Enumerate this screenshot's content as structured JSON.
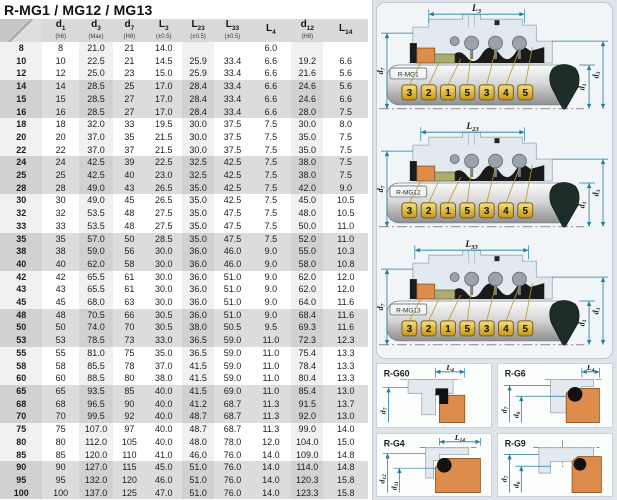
{
  "title": "R-MG1 / MG12 / MG13",
  "colors": {
    "dimension": "#1d7da3",
    "tag_fill": "#e9c654",
    "tag_border": "#7c5e12",
    "orange": "#dd8c4c",
    "olive": "#abac6e",
    "black_part": "#1a1a1a",
    "gland": "#e3eaef",
    "gland_stroke": "#98a6b0",
    "row_band": "#dcdcdc",
    "header_bg": "#d9d9d9"
  },
  "table": {
    "headers": [
      {
        "main": "d",
        "sub": "1",
        "note": "(h6)"
      },
      {
        "main": "d",
        "sub": "3",
        "note": "(Max)"
      },
      {
        "main": "d",
        "sub": "7",
        "note": "(H8)"
      },
      {
        "main": "L",
        "sub": "3",
        "note": "(±0.5)"
      },
      {
        "main": "L",
        "sub": "23",
        "note": "(±0.5)"
      },
      {
        "main": "L",
        "sub": "33",
        "note": "(±0.5)"
      },
      {
        "main": "L",
        "sub": "4",
        "note": ""
      },
      {
        "main": "d",
        "sub": "12",
        "note": "(H8)"
      },
      {
        "main": "L",
        "sub": "14",
        "note": ""
      }
    ],
    "rows": [
      [
        "8",
        "8",
        "21.0",
        "21",
        "14.0",
        "",
        "",
        "6.0",
        "",
        ""
      ],
      [
        "10",
        "10",
        "22.5",
        "21",
        "14.5",
        "25.9",
        "33.4",
        "6.6",
        "19.2",
        "6.6"
      ],
      [
        "12",
        "12",
        "25.0",
        "23",
        "15.0",
        "25.9",
        "33.4",
        "6.6",
        "21.6",
        "5.6"
      ],
      [
        "14",
        "14",
        "28.5",
        "25",
        "17.0",
        "28.4",
        "33.4",
        "6.6",
        "24.6",
        "5.6"
      ],
      [
        "15",
        "15",
        "28.5",
        "27",
        "17.0",
        "28.4",
        "33.4",
        "6.6",
        "24.6",
        "6.6"
      ],
      [
        "16",
        "16",
        "28.5",
        "27",
        "17.0",
        "28.4",
        "33.4",
        "6.6",
        "28.0",
        "7.5"
      ],
      [
        "18",
        "18",
        "32.0",
        "33",
        "19.5",
        "30.0",
        "37.5",
        "7.5",
        "30.0",
        "8.0"
      ],
      [
        "20",
        "20",
        "37.0",
        "35",
        "21.5",
        "30.0",
        "37.5",
        "7.5",
        "35.0",
        "7.5"
      ],
      [
        "22",
        "22",
        "37.0",
        "37",
        "21.5",
        "30.0",
        "37.5",
        "7.5",
        "35.0",
        "7.5"
      ],
      [
        "24",
        "24",
        "42.5",
        "39",
        "22.5",
        "32.5",
        "42.5",
        "7.5",
        "38.0",
        "7.5"
      ],
      [
        "25",
        "25",
        "42.5",
        "40",
        "23.0",
        "32.5",
        "42.5",
        "7.5",
        "38.0",
        "7.5"
      ],
      [
        "28",
        "28",
        "49.0",
        "43",
        "26.5",
        "35.0",
        "42.5",
        "7.5",
        "42.0",
        "9.0"
      ],
      [
        "30",
        "30",
        "49.0",
        "45",
        "26.5",
        "35.0",
        "42.5",
        "7.5",
        "45.0",
        "10.5"
      ],
      [
        "32",
        "32",
        "53.5",
        "48",
        "27.5",
        "35.0",
        "47.5",
        "7.5",
        "48.0",
        "10.5"
      ],
      [
        "33",
        "33",
        "53.5",
        "48",
        "27.5",
        "35.0",
        "47.5",
        "7.5",
        "50.0",
        "11.0"
      ],
      [
        "35",
        "35",
        "57.0",
        "50",
        "28.5",
        "35.0",
        "47.5",
        "7.5",
        "52.0",
        "11.0"
      ],
      [
        "38",
        "38",
        "59.0",
        "56",
        "30.0",
        "36.0",
        "46.0",
        "9.0",
        "55.0",
        "10.3"
      ],
      [
        "40",
        "40",
        "62.0",
        "58",
        "30.0",
        "36.0",
        "46.0",
        "9.0",
        "58.0",
        "10.8"
      ],
      [
        "42",
        "42",
        "65.5",
        "61",
        "30.0",
        "36.0",
        "51.0",
        "9.0",
        "62.0",
        "12.0"
      ],
      [
        "43",
        "43",
        "65.5",
        "61",
        "30.0",
        "36.0",
        "51.0",
        "9.0",
        "62.0",
        "12.0"
      ],
      [
        "45",
        "45",
        "68.0",
        "63",
        "30.0",
        "36.0",
        "51.0",
        "9.0",
        "64.0",
        "11.6"
      ],
      [
        "48",
        "48",
        "70.5",
        "66",
        "30.5",
        "36.0",
        "51.0",
        "9.0",
        "68.4",
        "11.6"
      ],
      [
        "50",
        "50",
        "74.0",
        "70",
        "30.5",
        "38.0",
        "50.5",
        "9.5",
        "69.3",
        "11.6"
      ],
      [
        "53",
        "53",
        "78.5",
        "73",
        "33.0",
        "36.5",
        "59.0",
        "11.0",
        "72.3",
        "12.3"
      ],
      [
        "55",
        "55",
        "81.0",
        "75",
        "35.0",
        "36.5",
        "59.0",
        "11.0",
        "75.4",
        "13.3"
      ],
      [
        "58",
        "58",
        "85.5",
        "78",
        "37.0",
        "41.5",
        "59.0",
        "11.0",
        "78.4",
        "13.3"
      ],
      [
        "60",
        "60",
        "88.5",
        "80",
        "38.0",
        "41.5",
        "59.0",
        "11.0",
        "80.4",
        "13.3"
      ],
      [
        "65",
        "65",
        "93.5",
        "85",
        "40.0",
        "41.5",
        "69.0",
        "11.0",
        "85.4",
        "13.0"
      ],
      [
        "68",
        "68",
        "96.5",
        "90",
        "40.0",
        "41.2",
        "68.7",
        "11.3",
        "91.5",
        "13.7"
      ],
      [
        "70",
        "70",
        "99.5",
        "92",
        "40.0",
        "48.7",
        "68.7",
        "11.3",
        "92.0",
        "13.0"
      ],
      [
        "75",
        "75",
        "107.0",
        "97",
        "40.0",
        "48.7",
        "68.7",
        "11.3",
        "99.0",
        "14.0"
      ],
      [
        "80",
        "80",
        "112.0",
        "105",
        "40.0",
        "48.0",
        "78.0",
        "12.0",
        "104.0",
        "15.0"
      ],
      [
        "85",
        "85",
        "120.0",
        "110",
        "41.0",
        "46.0",
        "76.0",
        "14.0",
        "109.0",
        "14.8"
      ],
      [
        "90",
        "90",
        "127.0",
        "115",
        "45.0",
        "51.0",
        "76.0",
        "14.0",
        "114.0",
        "14.8"
      ],
      [
        "95",
        "95",
        "132.0",
        "120",
        "46.0",
        "51.0",
        "76.0",
        "14.0",
        "120.3",
        "15.8"
      ],
      [
        "100",
        "100",
        "137.0",
        "125",
        "47.0",
        "51.0",
        "76.0",
        "14.0",
        "123.3",
        "15.8"
      ]
    ]
  },
  "diagrams": {
    "mg": [
      {
        "name": "R-MG1",
        "dim": {
          "main": "L",
          "sub": "3"
        },
        "left_dim": {
          "main": "d",
          "sub": "7"
        },
        "right_dims": [
          {
            "main": "d",
            "sub": "1"
          },
          {
            "main": "d",
            "sub": "3"
          }
        ],
        "tags": [
          "3",
          "2",
          "1",
          "5",
          "3",
          "4",
          "5"
        ]
      },
      {
        "name": "R-MG12",
        "dim": {
          "main": "L",
          "sub": "23"
        },
        "left_dim": {
          "main": "d",
          "sub": "7"
        },
        "right_dims": [
          {
            "main": "d",
            "sub": "1"
          },
          {
            "main": "d",
            "sub": "3"
          }
        ],
        "tags": [
          "3",
          "2",
          "1",
          "5",
          "3",
          "4",
          "5"
        ]
      },
      {
        "name": "R-MG13",
        "dim": {
          "main": "L",
          "sub": "33"
        },
        "left_dim": {
          "main": "d",
          "sub": "7"
        },
        "right_dims": [
          {
            "main": "d",
            "sub": "1"
          },
          {
            "main": "d",
            "sub": "3"
          }
        ],
        "tags": [
          "3",
          "2",
          "1",
          "5",
          "3",
          "4",
          "5"
        ]
      }
    ],
    "g_seats": [
      {
        "name": "R-G60",
        "style": "corner",
        "h_dim": {
          "main": "L",
          "sub": "4"
        },
        "v_dims": [
          {
            "main": "d",
            "sub": "7"
          }
        ]
      },
      {
        "name": "R-G6",
        "style": "oring",
        "h_dim": {
          "main": "L",
          "sub": "4"
        },
        "v_dims": [
          {
            "main": "d",
            "sub": "7"
          },
          {
            "main": "d",
            "sub": "6"
          }
        ]
      },
      {
        "name": "R-G4",
        "style": "oring-large",
        "h_dim": {
          "main": "L",
          "sub": "14"
        },
        "v_dims": [
          {
            "main": "d",
            "sub": "12"
          },
          {
            "main": "d",
            "sub": "11"
          }
        ]
      },
      {
        "name": "R-G9",
        "style": "split",
        "h_dim": null,
        "v_dims": [
          {
            "main": "d",
            "sub": "7"
          },
          {
            "main": "d",
            "sub": "6"
          }
        ]
      }
    ]
  }
}
